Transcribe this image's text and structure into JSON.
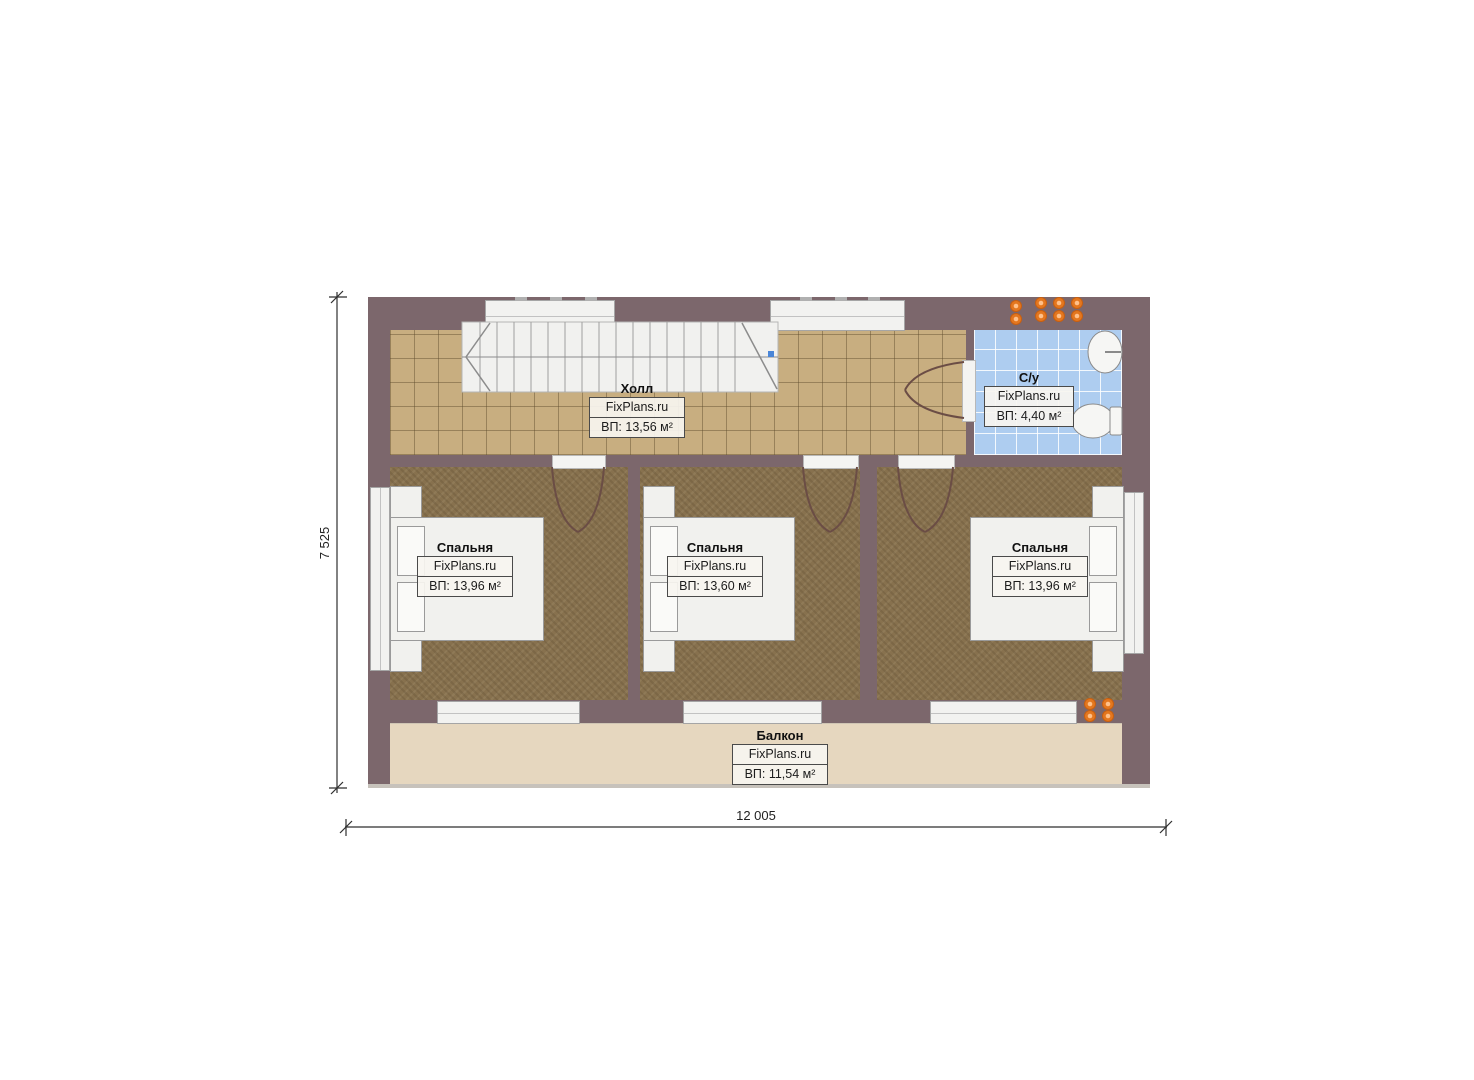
{
  "brand": "FixPlans.ru",
  "rooms": {
    "hall": {
      "name": "Холл",
      "area": "ВП: 13,56 м²"
    },
    "bathroom": {
      "name": "С/у",
      "area": "ВП: 4,40 м²"
    },
    "bedroom_left": {
      "name": "Спальня",
      "area": "ВП: 13,96 м²"
    },
    "bedroom_middle": {
      "name": "Спальня",
      "area": "ВП: 13,60 м²"
    },
    "bedroom_right": {
      "name": "Спальня",
      "area": "ВП: 13,96 м²"
    },
    "balcony": {
      "name": "Балкон",
      "area": "ВП: 11,54 м²"
    }
  },
  "dimensions": {
    "width_mm": "12 005",
    "height_mm": "7 525"
  },
  "colors": {
    "wall": "#7c676c",
    "hall_floor": "#c8ae80",
    "bathroom_floor": "#aecdf0",
    "bedroom_floor": "#87714e",
    "balcony_floor": "#e6d7bf",
    "marker_orange": "#e4771f"
  }
}
